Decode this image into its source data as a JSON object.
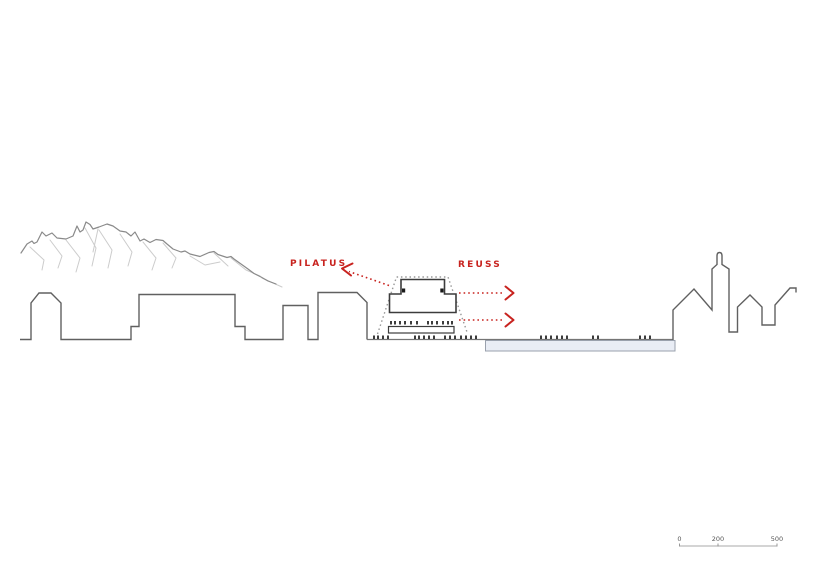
{
  "annotations": {
    "pilatus_label": "PILATUS",
    "reuss_label": "REUSS"
  },
  "scale_bar": {
    "tick_labels": [
      "0",
      "200",
      "500"
    ]
  },
  "colors": {
    "annotation_red": "#c8231f",
    "water_fill": "#e9edf5"
  }
}
